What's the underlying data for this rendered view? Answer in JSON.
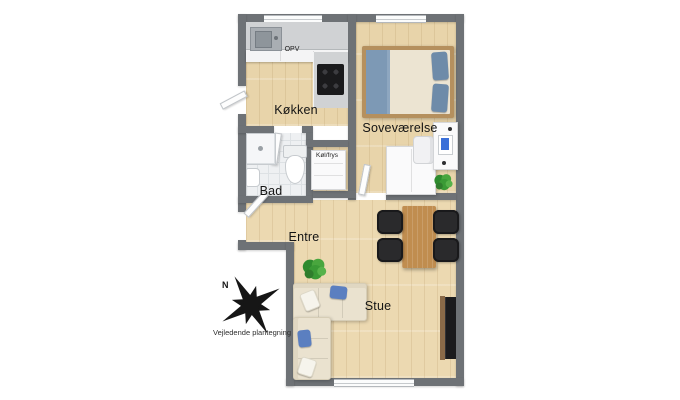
{
  "plan": {
    "type": "apartment-floor-plan-3d",
    "rooms": {
      "kokken": {
        "label": "Køkken"
      },
      "sovevaerelse": {
        "label": "Soveværelse"
      },
      "bad": {
        "label": "Bad"
      },
      "entre": {
        "label": "Entre"
      },
      "stue": {
        "label": "Stue"
      }
    },
    "appliances": {
      "opv": "OPV",
      "kol_frys": "Køl/frys"
    },
    "compass": {
      "north": "N"
    },
    "disclaimer": "Vejledende plantegning",
    "colors": {
      "wall": "#6e7276",
      "wood_floor": "#e8d4aa",
      "tile_floor": "#eef0f2",
      "counter": "#d0d2d4",
      "table_wood": "#c08d4f",
      "sofa": "#eae2cf",
      "accent_blue": "#5b7fc0",
      "plant_green": "#3e9b3a",
      "black_furniture": "#232325"
    }
  }
}
